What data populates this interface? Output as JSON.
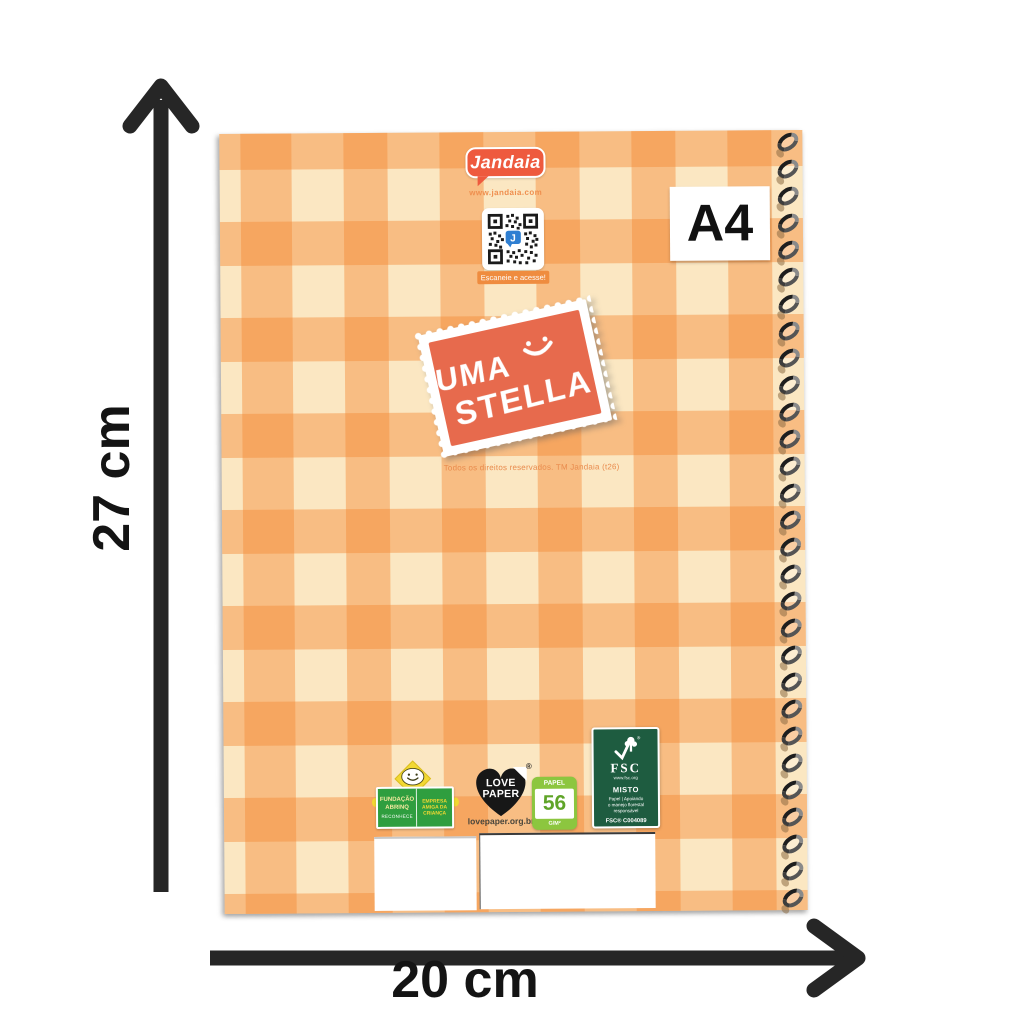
{
  "measurements": {
    "height": "27 cm",
    "width": "20 cm"
  },
  "size_badge": "A4",
  "brand": {
    "name": "Jandaia",
    "website": "www.jandaia.com",
    "qr_caption": "Escaneie e acesse!",
    "qr_letter": "J"
  },
  "stamp": {
    "word1": "UMA",
    "word2": "STELLA"
  },
  "rights": "Todos os direitos reservados. TM Jandaia (t26)",
  "certs": {
    "abrinq": {
      "left1": "FUNDAÇÃO",
      "left2": "ABRINQ",
      "right1": "EMPRESA",
      "right2": "AMIGA DA",
      "right3": "CRIANÇA",
      "bottom": "RECONHECE"
    },
    "lovepaper": {
      "word1": "LOVE",
      "word2": "PAPER",
      "reg": "®",
      "url": "lovepaper.org.br"
    },
    "papel": {
      "header": "PAPEL",
      "value": "56",
      "unit": "G/M²"
    },
    "fsc": {
      "brand": "FSC",
      "site": "www.fsc.org",
      "mix": "MISTO",
      "desc1": "Papel | Apoiando",
      "desc2": "o manejo florestal",
      "desc3": "responsável",
      "code": "FSC® C004089"
    }
  },
  "colors": {
    "brand_red": "#EE5A3E",
    "gingham_orange": "#F48A36",
    "cover_cream": "#FBE7C2",
    "stamp_coral": "#E76A4D",
    "abrinq_green": "#2F9E3F",
    "papel_green": "#8CC63F",
    "fsc_green": "#1E5C40",
    "qr_blue": "#2F7FD2",
    "arrow_black": "#262626"
  }
}
